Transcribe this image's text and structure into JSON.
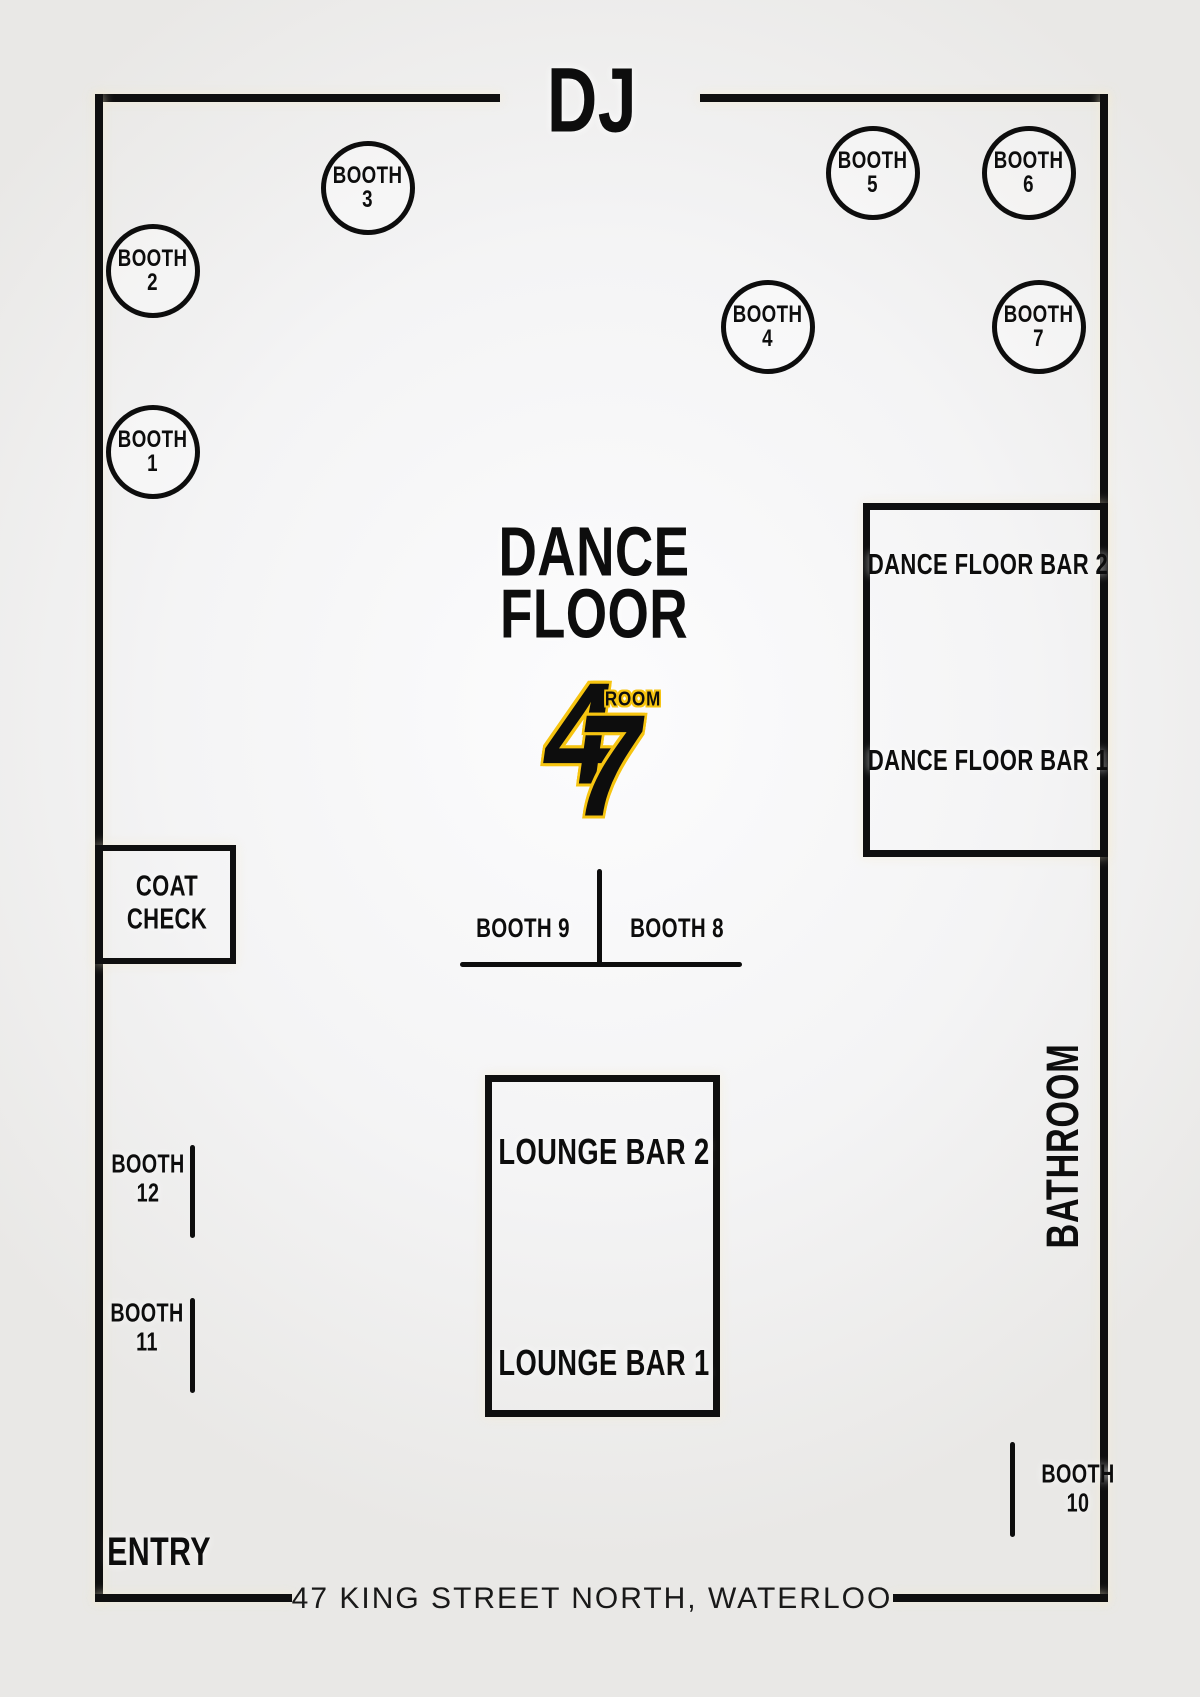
{
  "labels": {
    "dj": "DJ",
    "dance_floor_line1": "DANCE",
    "dance_floor_line2": "FLOOR",
    "coat_check_line1": "COAT",
    "coat_check_line2": "CHECK",
    "bathroom": "BATHROOM",
    "entry": "ENTRY",
    "address": "47 KING STREET NORTH, WATERLOO"
  },
  "logo": {
    "digit_4": "4",
    "digit_7": "7",
    "room": "ROOM"
  },
  "bars": {
    "dance_floor_bar_2": "DANCE FLOOR BAR 2",
    "dance_floor_bar_1": "DANCE FLOOR BAR 1",
    "lounge_bar_2": "LOUNGE BAR 2",
    "lounge_bar_1": "LOUNGE BAR 1"
  },
  "booth_circles": {
    "b1": {
      "line1": "BOOTH",
      "line2": "1"
    },
    "b2": {
      "line1": "BOOTH",
      "line2": "2"
    },
    "b3": {
      "line1": "BOOTH",
      "line2": "3"
    },
    "b4": {
      "line1": "BOOTH",
      "line2": "4"
    },
    "b5": {
      "line1": "BOOTH",
      "line2": "5"
    },
    "b6": {
      "line1": "BOOTH",
      "line2": "6"
    },
    "b7": {
      "line1": "BOOTH",
      "line2": "7"
    }
  },
  "booth_seats": {
    "b8": {
      "text": "BOOTH 8"
    },
    "b9": {
      "text": "BOOTH 9"
    },
    "b10": {
      "line1": "BOOTH",
      "line2": "10"
    },
    "b11": {
      "line1": "BOOTH",
      "line2": "11"
    },
    "b12": {
      "line1": "BOOTH",
      "line2": "12"
    }
  },
  "colors": {
    "wall": "#0f0f0f",
    "text": "#0d0d0d",
    "accent_yellow": "#f6c410",
    "background_light": "#fcfcfd",
    "background_dark": "#e9e8e6"
  }
}
